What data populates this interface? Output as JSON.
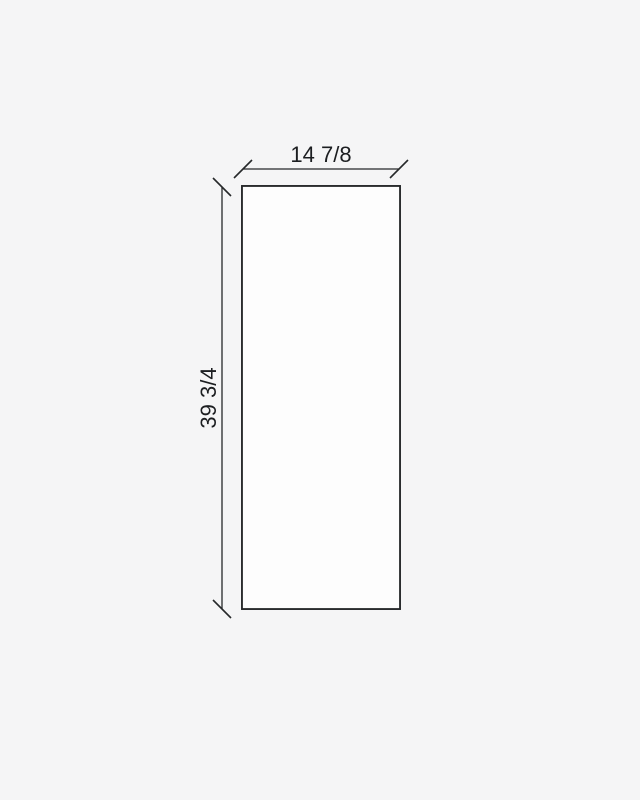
{
  "canvas": {
    "background": "#f5f5f6",
    "line_color": "#26282a",
    "panel_fill": "#fdfdfd"
  },
  "diagram": {
    "type": "dimensioned-rectangle",
    "width_label": "14 7/8",
    "height_label": "39 3/4"
  }
}
